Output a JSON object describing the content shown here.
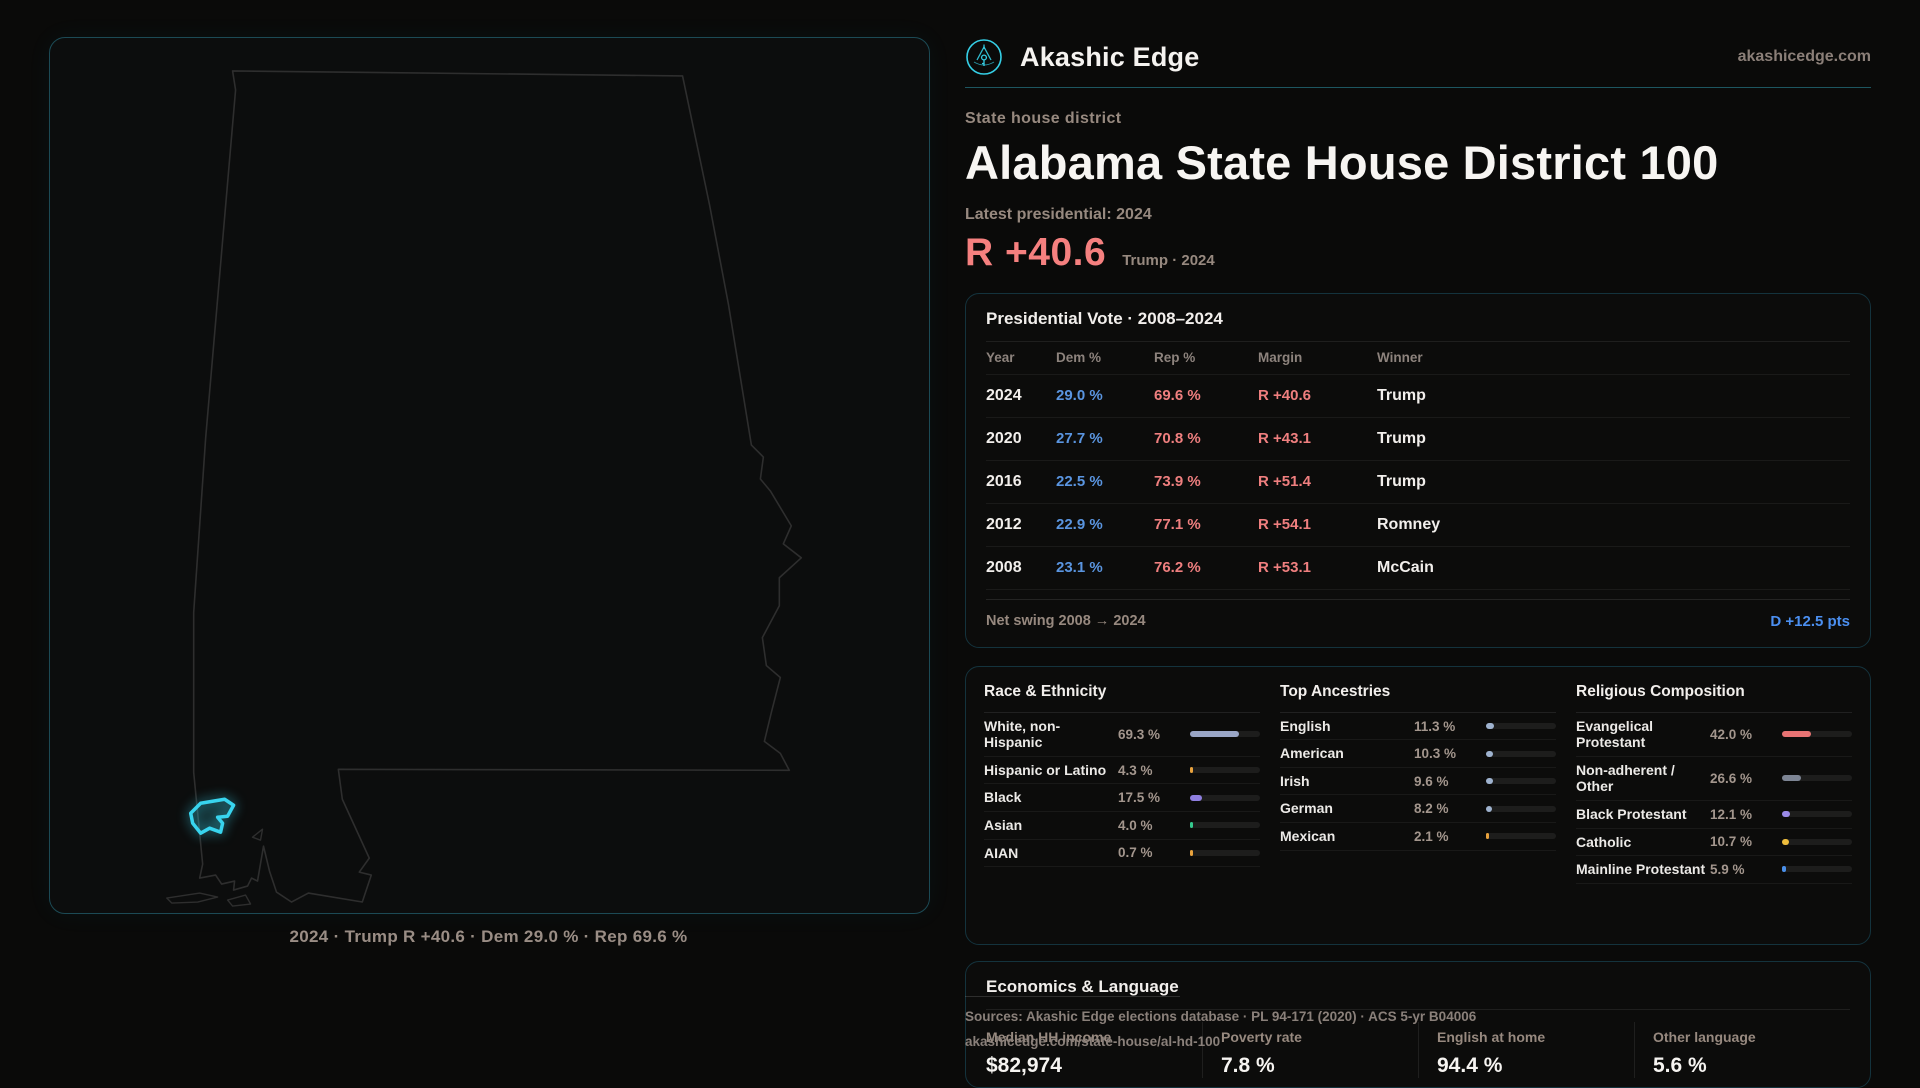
{
  "colors": {
    "accent": "#38d4ee",
    "dem_blue": "#5a95e0",
    "rep_red": "#ef7f7f",
    "swing_blue": "#4b8ff0",
    "headline_red": "#f5807f"
  },
  "brand": {
    "name": "Akashic Edge",
    "domain": "akashicedge.com"
  },
  "header": {
    "kicker": "State house district",
    "title": "Alabama State House District 100",
    "latest_label": "Latest presidential: 2024",
    "headline_value": "R +40.6",
    "headline_caption": "Trump · 2024"
  },
  "map": {
    "region": "Alabama",
    "highlight": "District 100",
    "caption": "2024 · Trump R +40.6 · Dem 29.0 % · Rep 69.6 %"
  },
  "presidential": {
    "title": "Presidential Vote · 2008–2024",
    "columns": [
      "Year",
      "Dem %",
      "Rep %",
      "Margin",
      "Winner"
    ],
    "rows": [
      {
        "year": "2024",
        "dem": "29.0 %",
        "rep": "69.6 %",
        "margin": "R +40.6",
        "winner": "Trump"
      },
      {
        "year": "2020",
        "dem": "27.7 %",
        "rep": "70.8 %",
        "margin": "R +43.1",
        "winner": "Trump"
      },
      {
        "year": "2016",
        "dem": "22.5 %",
        "rep": "73.9 %",
        "margin": "R +51.4",
        "winner": "Trump"
      },
      {
        "year": "2012",
        "dem": "22.9 %",
        "rep": "77.1 %",
        "margin": "R +54.1",
        "winner": "Romney"
      },
      {
        "year": "2008",
        "dem": "23.1 %",
        "rep": "76.2 %",
        "margin": "R +53.1",
        "winner": "McCain"
      }
    ],
    "net_swing_label": "Net swing 2008 → 2024",
    "net_swing_value": "D +12.5 pts"
  },
  "race": {
    "title": "Race & Ethnicity",
    "rows": [
      {
        "label": "White, non-Hispanic",
        "value": "69.3 %",
        "pct": 69.3,
        "color": "#9aa6c6"
      },
      {
        "label": "Hispanic or Latino",
        "value": "4.3 %",
        "pct": 4.3,
        "color": "#e8a23d"
      },
      {
        "label": "Black",
        "value": "17.5 %",
        "pct": 17.5,
        "color": "#8f7fe0"
      },
      {
        "label": "Asian",
        "value": "4.0 %",
        "pct": 4.0,
        "color": "#35c98e"
      },
      {
        "label": "AIAN",
        "value": "0.7 %",
        "pct": 0.7,
        "color": "#e8a23d"
      }
    ]
  },
  "ancestries": {
    "title": "Top Ancestries",
    "rows": [
      {
        "label": "English",
        "value": "11.3 %",
        "pct": 11.3,
        "color": "#9fb3cf"
      },
      {
        "label": "American",
        "value": "10.3 %",
        "pct": 10.3,
        "color": "#9fb3cf"
      },
      {
        "label": "Irish",
        "value": "9.6 %",
        "pct": 9.6,
        "color": "#9fb3cf"
      },
      {
        "label": "German",
        "value": "8.2 %",
        "pct": 8.2,
        "color": "#9fb3cf"
      },
      {
        "label": "Mexican",
        "value": "2.1 %",
        "pct": 2.1,
        "color": "#e8a23d"
      }
    ]
  },
  "religion": {
    "title": "Religious Composition",
    "rows": [
      {
        "label": "Evangelical Protestant",
        "value": "42.0 %",
        "pct": 42.0,
        "color": "#e87373"
      },
      {
        "label": "Non-adherent / Other",
        "value": "26.6 %",
        "pct": 26.6,
        "color": "#7d8594"
      },
      {
        "label": "Black Protestant",
        "value": "12.1 %",
        "pct": 12.1,
        "color": "#9b8ae8"
      },
      {
        "label": "Catholic",
        "value": "10.7 %",
        "pct": 10.7,
        "color": "#eebd3c"
      },
      {
        "label": "Mainline Protestant",
        "value": "5.9 %",
        "pct": 5.9,
        "color": "#4a8fe8"
      }
    ]
  },
  "economics": {
    "title": "Economics & Language",
    "stats": [
      {
        "label": "Median HH income",
        "value": "$82,974"
      },
      {
        "label": "Poverty rate",
        "value": "7.8 %"
      },
      {
        "label": "English at home",
        "value": "94.4 %"
      },
      {
        "label": "Other language",
        "value": "5.6 %"
      }
    ]
  },
  "sources": {
    "line1": "Sources: Akashic Edge elections database · PL 94-171 (2020) · ACS 5-yr B04006",
    "line2": "akashicedge.com/state-house/al-hd-100"
  }
}
